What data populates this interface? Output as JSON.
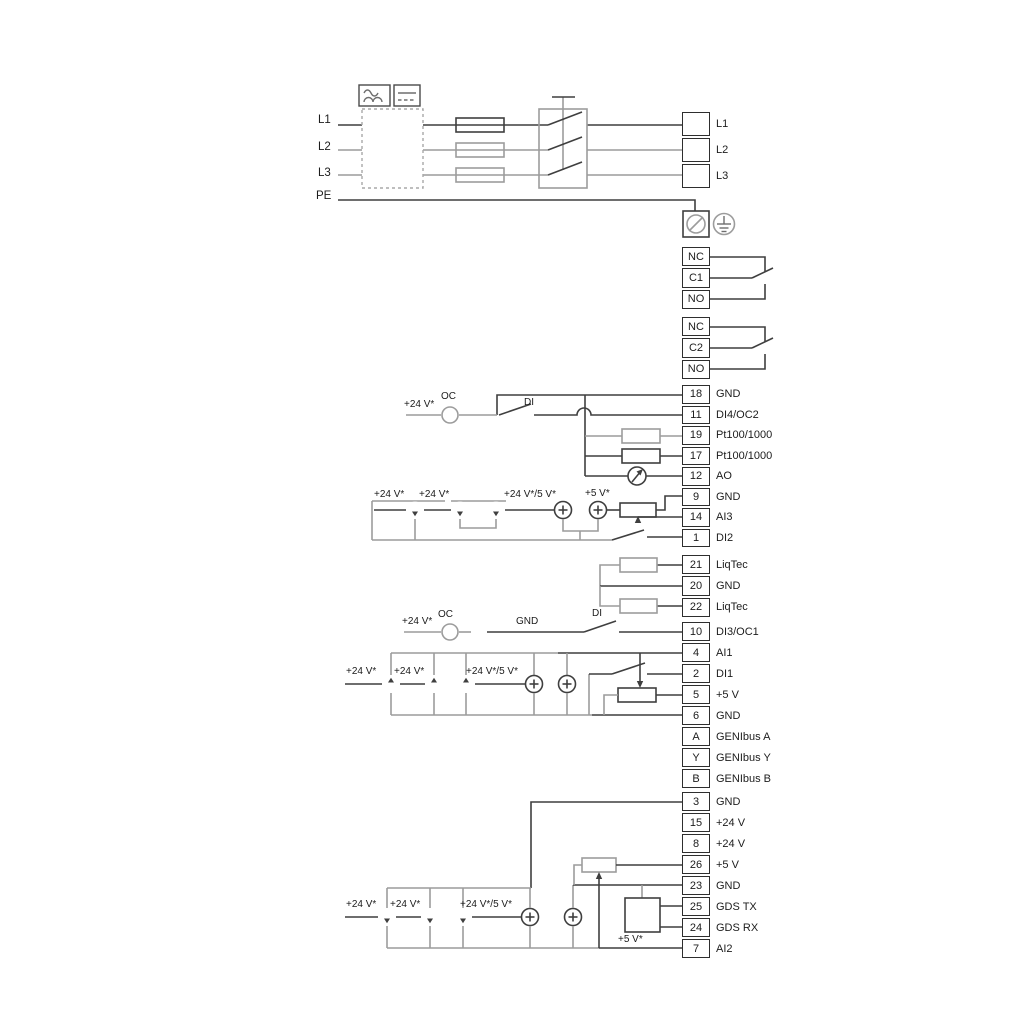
{
  "title": "Wiring diagram",
  "colors": {
    "wire_dark": "#3f3f3f",
    "wire_gray": "#9c9c9c"
  },
  "labels": {
    "p24": "+24 V*",
    "p24_5": "+24 V*/5 V*",
    "p5s": "+5 V*",
    "oc": "OC",
    "di": "DI",
    "gnd": "GND"
  },
  "power_inputs": {
    "l1": "L1",
    "l2": "L2",
    "l3": "L3",
    "pe": "PE"
  },
  "blocks": {
    "power": {
      "rows": [
        {
          "label": "L1"
        },
        {
          "label": "L2"
        },
        {
          "label": "L3"
        }
      ]
    },
    "relay1": {
      "rows": [
        {
          "num": "NC"
        },
        {
          "num": "C1"
        },
        {
          "num": "NO"
        }
      ]
    },
    "relay2": {
      "rows": [
        {
          "num": "NC"
        },
        {
          "num": "C2"
        },
        {
          "num": "NO"
        }
      ]
    },
    "io1": {
      "rows": [
        {
          "num": "18",
          "label": "GND"
        },
        {
          "num": "11",
          "label": "DI4/OC2"
        },
        {
          "num": "19",
          "label": "Pt100/1000"
        },
        {
          "num": "17",
          "label": "Pt100/1000"
        },
        {
          "num": "12",
          "label": "AO"
        },
        {
          "num": "9",
          "label": "GND"
        },
        {
          "num": "14",
          "label": "AI3"
        },
        {
          "num": "1",
          "label": "DI2"
        }
      ]
    },
    "liqtec": {
      "rows": [
        {
          "num": "21",
          "label": "LiqTec"
        },
        {
          "num": "20",
          "label": "GND"
        },
        {
          "num": "22",
          "label": "LiqTec"
        }
      ]
    },
    "io2": {
      "rows": [
        {
          "num": "10",
          "label": "DI3/OC1"
        },
        {
          "num": "4",
          "label": "AI1"
        },
        {
          "num": "2",
          "label": "DI1"
        },
        {
          "num": "5",
          "label": "+5 V"
        },
        {
          "num": "6",
          "label": "GND"
        },
        {
          "num": "A",
          "label": "GENIbus A"
        },
        {
          "num": "Y",
          "label": "GENIbus Y"
        },
        {
          "num": "B",
          "label": "GENIbus B"
        }
      ]
    },
    "io3": {
      "rows": [
        {
          "num": "3",
          "label": "GND"
        },
        {
          "num": "15",
          "label": "+24 V"
        },
        {
          "num": "8",
          "label": "+24 V"
        },
        {
          "num": "26",
          "label": "+5 V"
        },
        {
          "num": "23",
          "label": "GND"
        },
        {
          "num": "25",
          "label": "GDS TX"
        },
        {
          "num": "24",
          "label": "GDS RX"
        },
        {
          "num": "7",
          "label": "AI2"
        }
      ]
    }
  }
}
